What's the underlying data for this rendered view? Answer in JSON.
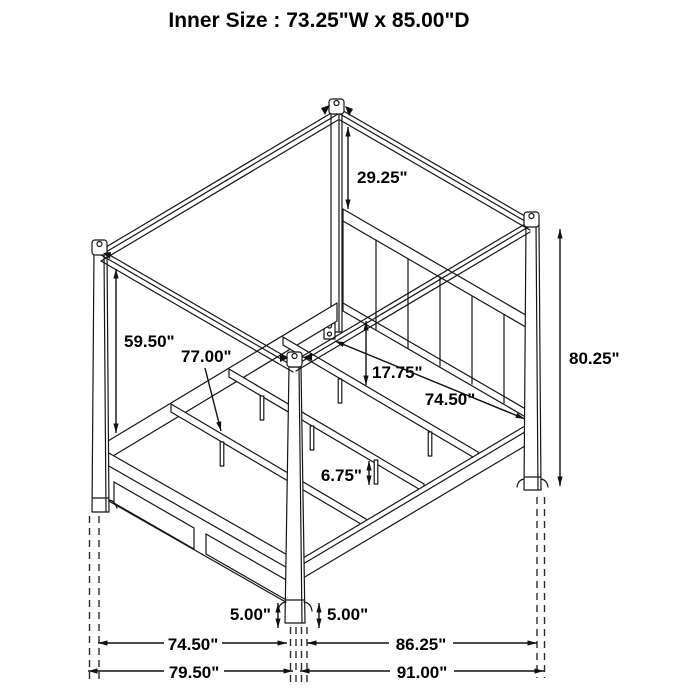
{
  "title": "Inner Size : 73.25\"W x 85.00\"D",
  "colors": {
    "line": "#161616",
    "background": "#ffffff",
    "text": "#000000"
  },
  "dimensions": {
    "canopy_to_headboard_height": "29.25\"",
    "rail_to_canopy_height": "59.50\"",
    "slat_rail_length": "77.00\"",
    "headboard_to_slat_gap": "17.75\"",
    "side_rail_length": "74.50\"",
    "overall_post_height": "80.25\"",
    "slat_leg_height": "6.75\"",
    "foot_height_left": "5.00\"",
    "foot_height_right": "5.00\"",
    "footboard_width_between_posts": "74.50\"",
    "side_depth_between_posts": "86.25\"",
    "overall_width": "79.50\"",
    "overall_depth": "91.00\""
  }
}
